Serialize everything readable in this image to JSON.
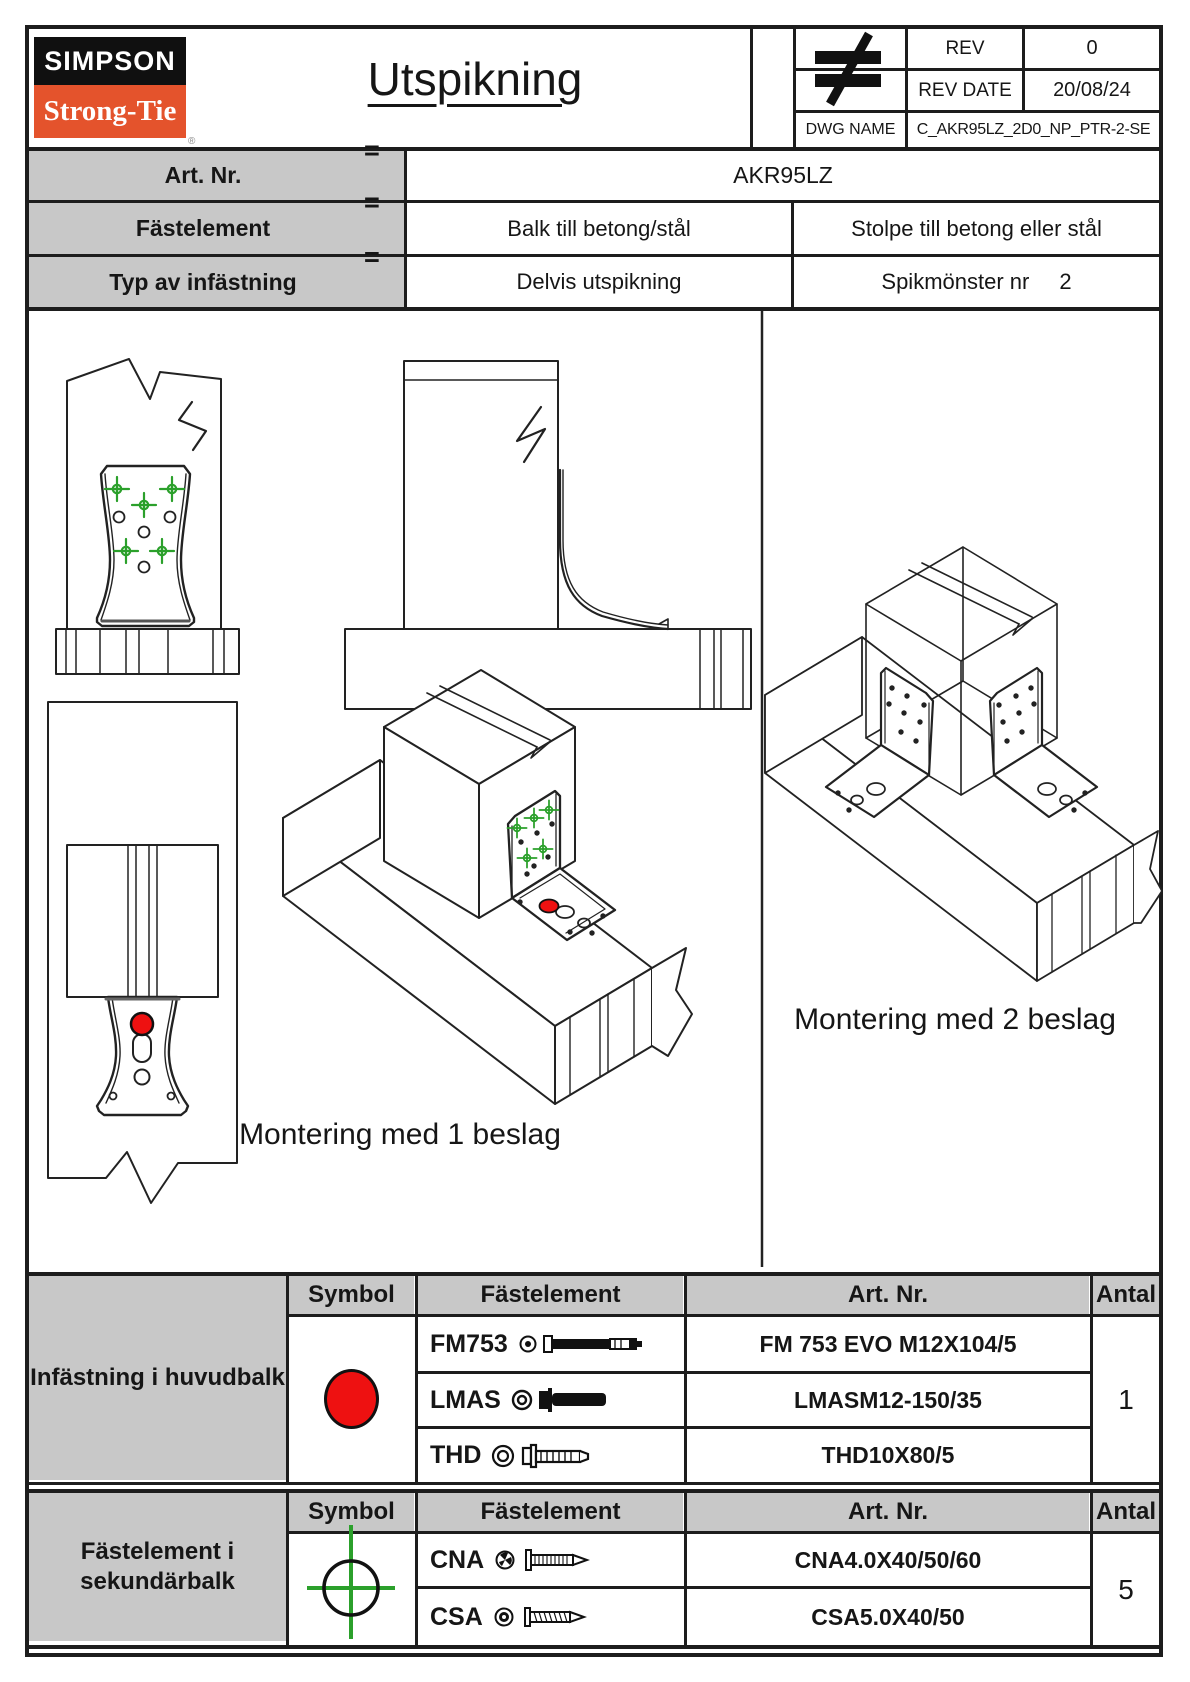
{
  "header": {
    "logo": {
      "top": "SIMPSON",
      "bottom": "Strong-Tie",
      "registered": "®"
    },
    "title": "Utspikning",
    "stamp_icon": "not-equal-icon",
    "rev": {
      "label": "REV",
      "value": "0"
    },
    "rev_date": {
      "label": "REV DATE",
      "value": "20/08/24"
    },
    "dwg": {
      "label": "DWG NAME",
      "value": "C_AKR95LZ_2D0_NP_PTR-2-SE"
    }
  },
  "info": {
    "art_row": {
      "label": "Art. Nr.",
      "eq": "=",
      "value": "AKR95LZ"
    },
    "fastener_row": {
      "label": "Fästelement",
      "eq": "=",
      "left": "Balk till betong/stål",
      "right": "Stolpe till betong eller stål"
    },
    "type_row": {
      "label": "Typ av infästning",
      "eq": "=",
      "left": "Delvis utspikning",
      "right_label": "Spikmönster nr",
      "right_value": "2"
    }
  },
  "drawings": {
    "caption_one_bracket": "Montering med 1 beslag",
    "caption_two_brackets": "Montering med 2 beslag",
    "nail_symbol": "green-crosshair-icon",
    "bolt_symbol": "red-circle-icon"
  },
  "main_table": {
    "row_label": "Infästning i huvudbalk",
    "col_symbol": "Symbol",
    "col_fastener": "Fästelement",
    "col_art": "Art. Nr.",
    "col_qty": "Antal",
    "symbol": "red-circle-icon",
    "rows": [
      {
        "name": "FM753",
        "art": "FM 753 EVO M12X104/5"
      },
      {
        "name": "LMAS",
        "art": "LMASM12-150/35"
      },
      {
        "name": "THD",
        "art": "THD10X80/5"
      }
    ],
    "qty": "1"
  },
  "secondary_table": {
    "row_label": "Fästelement i sekundärbalk",
    "col_symbol": "Symbol",
    "col_fastener": "Fästelement",
    "col_art": "Art. Nr.",
    "col_qty": "Antal",
    "symbol": "green-crosshair-icon",
    "rows": [
      {
        "name": "CNA",
        "art": "CNA4.0X40/50/60"
      },
      {
        "name": "CSA",
        "art": "CSA5.0X40/50"
      }
    ],
    "qty": "5"
  },
  "colors": {
    "bolt_symbol_red": "#ee1111",
    "nail_symbol_green": "#2ba02b",
    "brand_orange": "#e4532c",
    "cell_gray": "#c8c8c8"
  }
}
